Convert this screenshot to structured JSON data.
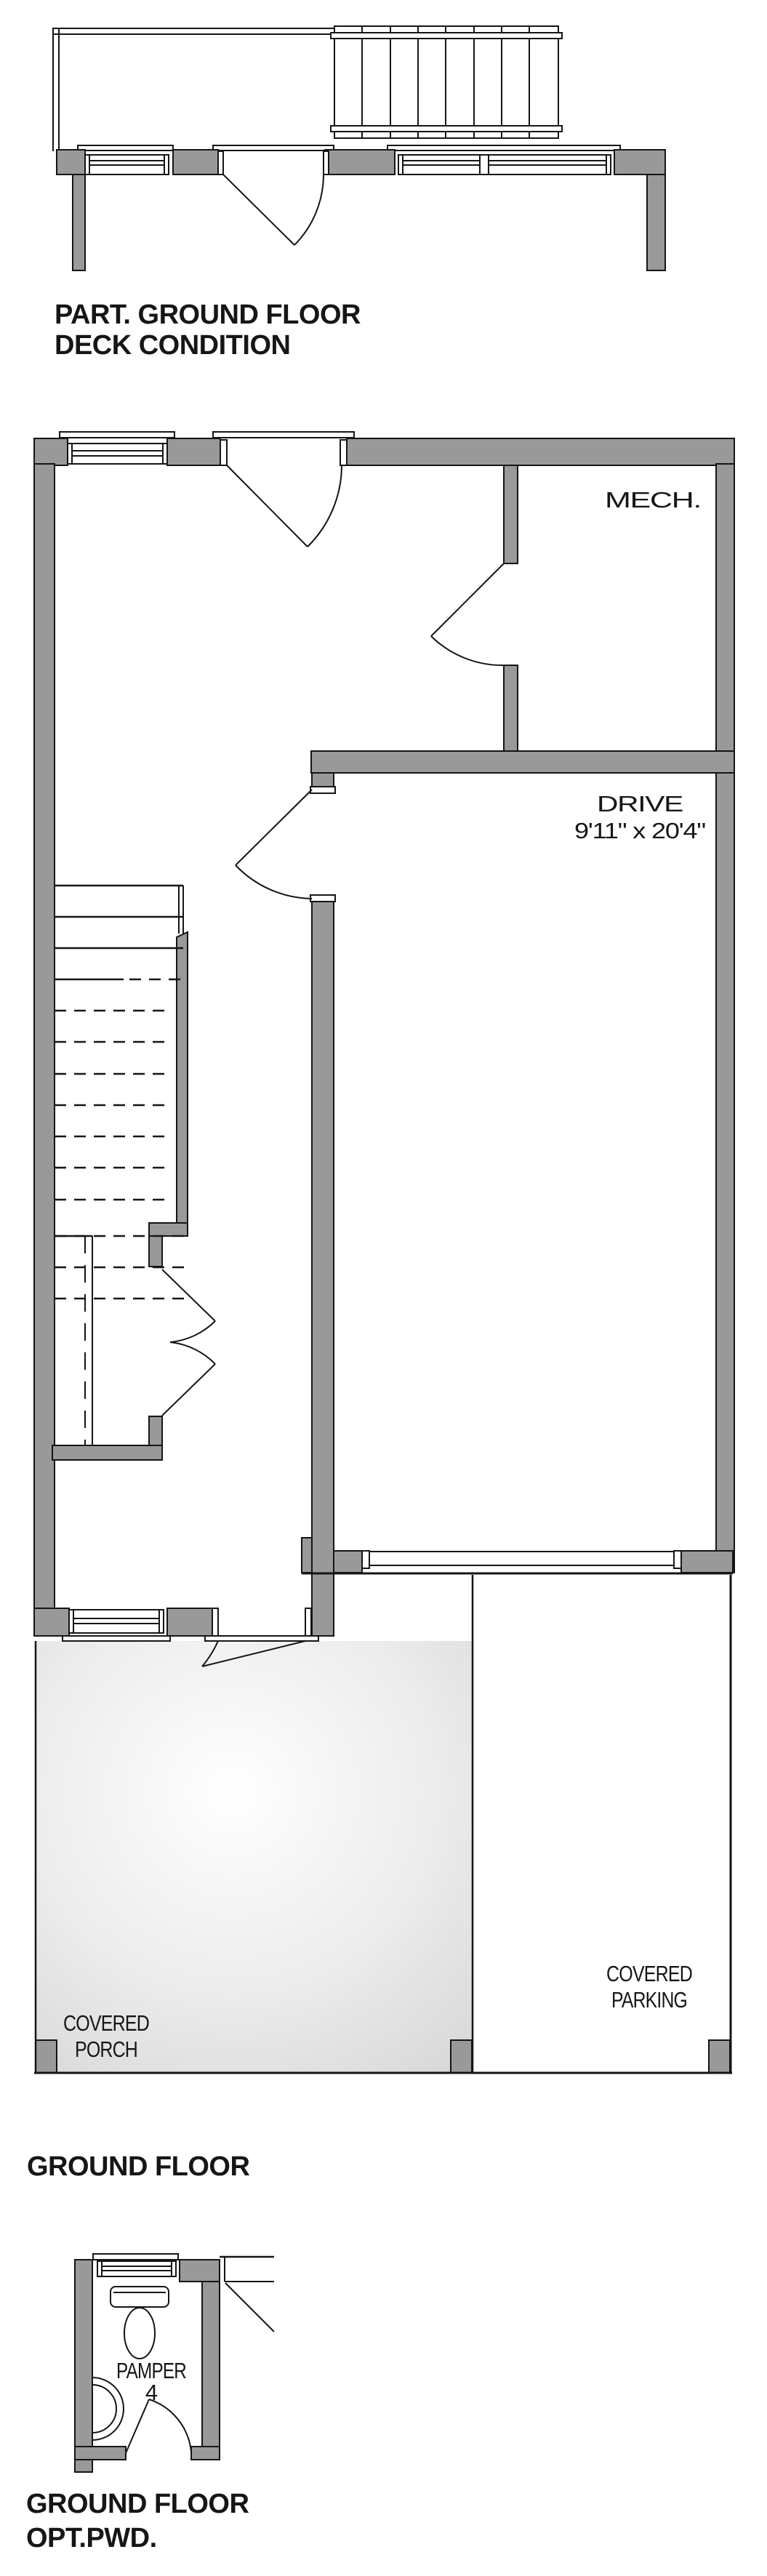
{
  "colors": {
    "wall_gray": "#999999",
    "line_black": "#151515",
    "porch_center": "#ffffff",
    "porch_edge": "#d6d6d6"
  },
  "deck_plan": {
    "title_line1": "PART. GROUND FLOOR",
    "title_line2": "DECK CONDITION"
  },
  "ground_floor": {
    "title": "GROUND FLOOR",
    "mech_label": "MECH.",
    "drive_label": "DRIVE",
    "drive_dimensions": "9'11\" x 20'4\"",
    "porch_label_line1": "COVERED",
    "porch_label_line2": "PORCH",
    "parking_label_line1": "COVERED",
    "parking_label_line2": "PARKING"
  },
  "pwd_plan": {
    "title_line1": "GROUND FLOOR",
    "title_line2": "OPT.PWD.",
    "room_label_line1": "PAMPER",
    "room_label_line2": "4"
  }
}
